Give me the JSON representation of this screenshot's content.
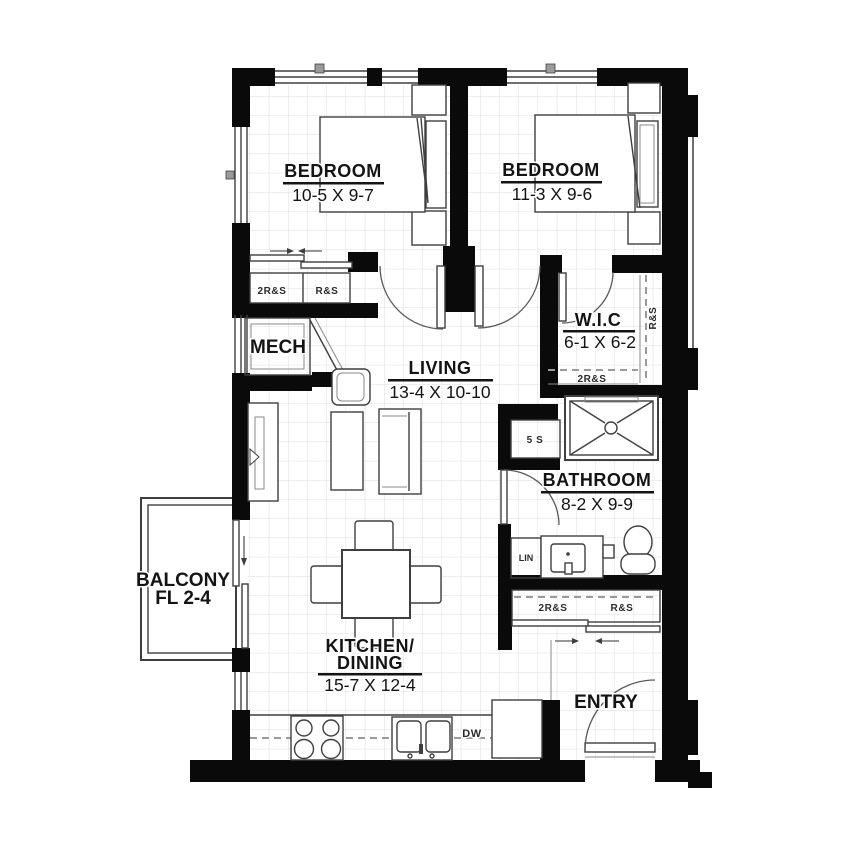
{
  "plan": {
    "rooms": {
      "bedroom1": {
        "name": "BEDROOM",
        "dims": "10-5 X 9-7"
      },
      "bedroom2": {
        "name": "BEDROOM",
        "dims": "11-3 X 9-6"
      },
      "living": {
        "name": "LIVING",
        "dims": "13-4 X 10-10"
      },
      "kitchen_dining": {
        "name_line1": "KITCHEN/",
        "name_line2": "DINING",
        "dims": "15-7 X 12-4"
      },
      "bathroom": {
        "name": "BATHROOM",
        "dims": "8-2 X 9-9"
      },
      "wic": {
        "name": "W.I.C",
        "dims": "6-1 X 6-2"
      },
      "mech": {
        "name": "MECH"
      },
      "balcony": {
        "name": "BALCONY",
        "floors": "FL 2-4"
      },
      "entry": {
        "name": "ENTRY"
      }
    },
    "closet_labels": {
      "bedroom1_left": "2R&S",
      "bedroom1_right": "R&S",
      "wic_rod": "R&S",
      "wic_bottom": "2R&S",
      "hall_shelf": "5 S",
      "linen": "LIN",
      "bath_left": "2R&S",
      "bath_right": "R&S"
    },
    "appliances": {
      "dishwasher": "DW"
    },
    "colors": {
      "wall": "#0a0a0a",
      "line": "#3f3f3f",
      "grid": "#dcdcdc",
      "background": "#ffffff"
    }
  }
}
